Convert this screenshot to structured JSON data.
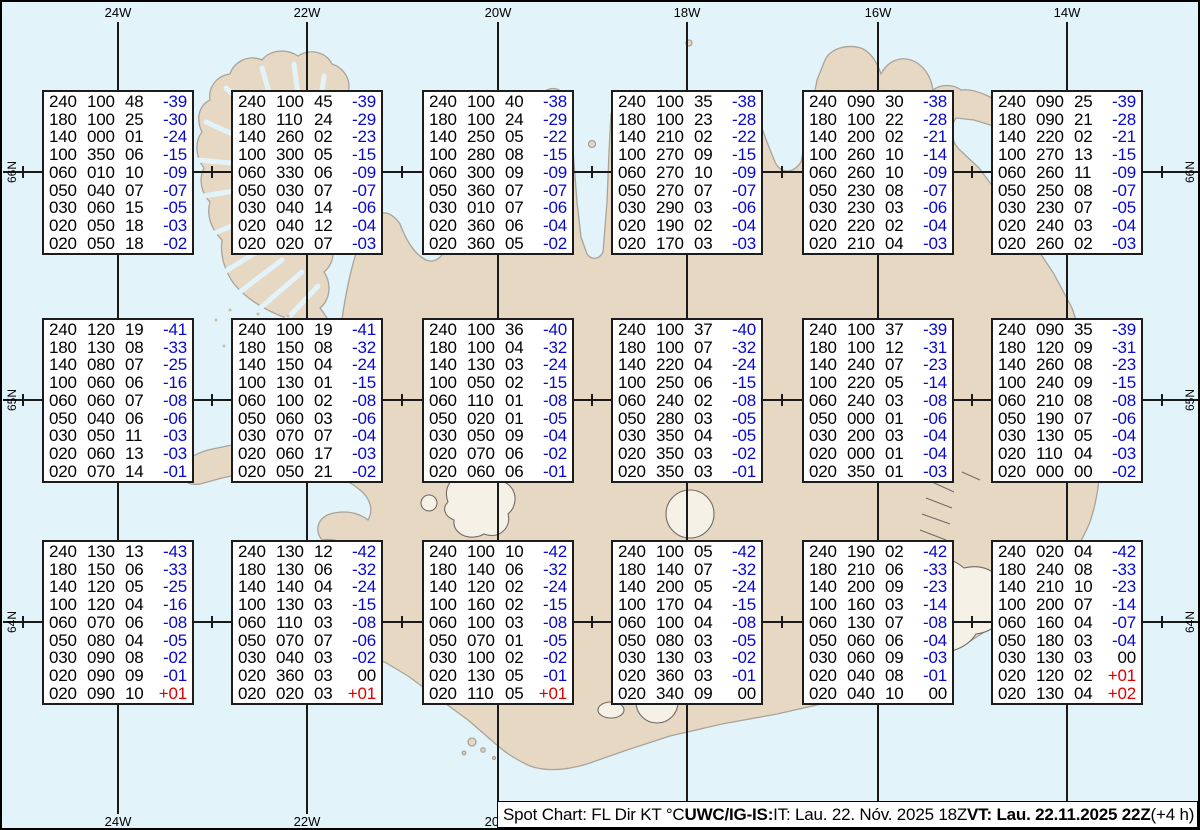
{
  "chart_title": "Spot Chart",
  "colors": {
    "ocean": "#e2f4fa",
    "land": "#e7d8c3",
    "coastline": "#a9a39a",
    "glacier": "#f6f1e7",
    "glacier_outline": "#6f6a62",
    "grid": "#1a1a1a",
    "temp_negative": "#0808cc",
    "temp_positive": "#dd0000"
  },
  "graticule": {
    "meridians": [
      {
        "label": "24W",
        "x": 116
      },
      {
        "label": "22W",
        "x": 305
      },
      {
        "label": "20W",
        "x": 496
      },
      {
        "label": "18W",
        "x": 685
      },
      {
        "label": "16W",
        "x": 876
      },
      {
        "label": "14W",
        "x": 1065
      }
    ],
    "latitudes": [
      {
        "label": "66N",
        "y": 170
      },
      {
        "label": "65N",
        "y": 398
      },
      {
        "label": "64N",
        "y": 620
      }
    ],
    "cross_xs": [
      21,
      210,
      400,
      590,
      780,
      970,
      1160
    ]
  },
  "columns": [
    "FL",
    "Dir",
    "KT",
    "Temp"
  ],
  "spots": [
    {
      "x": 40,
      "y": 88,
      "rows": [
        [
          "240",
          "100",
          "48",
          "-39"
        ],
        [
          "180",
          "100",
          "25",
          "-30"
        ],
        [
          "140",
          "000",
          "01",
          "-24"
        ],
        [
          "100",
          "350",
          "06",
          "-15"
        ],
        [
          "060",
          "010",
          "10",
          "-09"
        ],
        [
          "050",
          "040",
          "07",
          "-07"
        ],
        [
          "030",
          "060",
          "15",
          "-05"
        ],
        [
          "020",
          "050",
          "18",
          "-03"
        ],
        [
          "020",
          "050",
          "18",
          "-02"
        ]
      ]
    },
    {
      "x": 229,
      "y": 88,
      "rows": [
        [
          "240",
          "100",
          "45",
          "-39"
        ],
        [
          "180",
          "110",
          "24",
          "-29"
        ],
        [
          "140",
          "260",
          "02",
          "-23"
        ],
        [
          "100",
          "300",
          "05",
          "-15"
        ],
        [
          "060",
          "330",
          "06",
          "-09"
        ],
        [
          "050",
          "030",
          "07",
          "-07"
        ],
        [
          "030",
          "040",
          "14",
          "-06"
        ],
        [
          "020",
          "040",
          "12",
          "-04"
        ],
        [
          "020",
          "020",
          "07",
          "-03"
        ]
      ]
    },
    {
      "x": 420,
      "y": 88,
      "rows": [
        [
          "240",
          "100",
          "40",
          "-38"
        ],
        [
          "180",
          "100",
          "24",
          "-29"
        ],
        [
          "140",
          "250",
          "05",
          "-22"
        ],
        [
          "100",
          "280",
          "08",
          "-15"
        ],
        [
          "060",
          "300",
          "09",
          "-09"
        ],
        [
          "050",
          "360",
          "07",
          "-07"
        ],
        [
          "030",
          "010",
          "07",
          "-06"
        ],
        [
          "020",
          "360",
          "06",
          "-04"
        ],
        [
          "020",
          "360",
          "05",
          "-02"
        ]
      ]
    },
    {
      "x": 609,
      "y": 88,
      "rows": [
        [
          "240",
          "100",
          "35",
          "-38"
        ],
        [
          "180",
          "100",
          "23",
          "-28"
        ],
        [
          "140",
          "210",
          "02",
          "-22"
        ],
        [
          "100",
          "270",
          "09",
          "-15"
        ],
        [
          "060",
          "270",
          "10",
          "-09"
        ],
        [
          "050",
          "270",
          "07",
          "-07"
        ],
        [
          "030",
          "290",
          "03",
          "-06"
        ],
        [
          "020",
          "190",
          "02",
          "-04"
        ],
        [
          "020",
          "170",
          "03",
          "-03"
        ]
      ]
    },
    {
      "x": 800,
      "y": 88,
      "rows": [
        [
          "240",
          "090",
          "30",
          "-38"
        ],
        [
          "180",
          "100",
          "22",
          "-28"
        ],
        [
          "140",
          "200",
          "02",
          "-21"
        ],
        [
          "100",
          "260",
          "10",
          "-14"
        ],
        [
          "060",
          "260",
          "10",
          "-09"
        ],
        [
          "050",
          "230",
          "08",
          "-07"
        ],
        [
          "030",
          "230",
          "03",
          "-06"
        ],
        [
          "020",
          "220",
          "02",
          "-04"
        ],
        [
          "020",
          "210",
          "04",
          "-03"
        ]
      ]
    },
    {
      "x": 989,
      "y": 88,
      "rows": [
        [
          "240",
          "090",
          "25",
          "-39"
        ],
        [
          "180",
          "090",
          "21",
          "-28"
        ],
        [
          "140",
          "220",
          "02",
          "-21"
        ],
        [
          "100",
          "270",
          "13",
          "-15"
        ],
        [
          "060",
          "260",
          "11",
          "-09"
        ],
        [
          "050",
          "250",
          "08",
          "-07"
        ],
        [
          "030",
          "230",
          "07",
          "-05"
        ],
        [
          "020",
          "240",
          "03",
          "-04"
        ],
        [
          "020",
          "260",
          "02",
          "-03"
        ]
      ]
    },
    {
      "x": 40,
      "y": 316,
      "rows": [
        [
          "240",
          "120",
          "19",
          "-41"
        ],
        [
          "180",
          "130",
          "08",
          "-33"
        ],
        [
          "140",
          "080",
          "07",
          "-25"
        ],
        [
          "100",
          "060",
          "06",
          "-16"
        ],
        [
          "060",
          "060",
          "07",
          "-08"
        ],
        [
          "050",
          "040",
          "06",
          "-06"
        ],
        [
          "030",
          "050",
          "11",
          "-03"
        ],
        [
          "020",
          "060",
          "13",
          "-03"
        ],
        [
          "020",
          "070",
          "14",
          "-01"
        ]
      ]
    },
    {
      "x": 229,
      "y": 316,
      "rows": [
        [
          "240",
          "100",
          "19",
          "-41"
        ],
        [
          "180",
          "150",
          "08",
          "-32"
        ],
        [
          "140",
          "150",
          "04",
          "-24"
        ],
        [
          "100",
          "130",
          "01",
          "-15"
        ],
        [
          "060",
          "100",
          "02",
          "-08"
        ],
        [
          "050",
          "060",
          "03",
          "-06"
        ],
        [
          "030",
          "070",
          "07",
          "-04"
        ],
        [
          "020",
          "060",
          "17",
          "-03"
        ],
        [
          "020",
          "050",
          "21",
          "-02"
        ]
      ]
    },
    {
      "x": 420,
      "y": 316,
      "rows": [
        [
          "240",
          "100",
          "36",
          "-40"
        ],
        [
          "180",
          "100",
          "04",
          "-32"
        ],
        [
          "140",
          "130",
          "03",
          "-24"
        ],
        [
          "100",
          "050",
          "02",
          "-15"
        ],
        [
          "060",
          "110",
          "01",
          "-08"
        ],
        [
          "050",
          "020",
          "01",
          "-05"
        ],
        [
          "030",
          "050",
          "09",
          "-04"
        ],
        [
          "020",
          "070",
          "06",
          "-02"
        ],
        [
          "020",
          "060",
          "06",
          "-01"
        ]
      ]
    },
    {
      "x": 609,
      "y": 316,
      "rows": [
        [
          "240",
          "100",
          "37",
          "-40"
        ],
        [
          "180",
          "100",
          "07",
          "-32"
        ],
        [
          "140",
          "220",
          "04",
          "-24"
        ],
        [
          "100",
          "250",
          "06",
          "-15"
        ],
        [
          "060",
          "240",
          "02",
          "-08"
        ],
        [
          "050",
          "280",
          "03",
          "-05"
        ],
        [
          "030",
          "350",
          "04",
          "-05"
        ],
        [
          "020",
          "350",
          "03",
          "-02"
        ],
        [
          "020",
          "350",
          "03",
          "-01"
        ]
      ]
    },
    {
      "x": 800,
      "y": 316,
      "rows": [
        [
          "240",
          "100",
          "37",
          "-39"
        ],
        [
          "180",
          "100",
          "12",
          "-31"
        ],
        [
          "140",
          "240",
          "07",
          "-23"
        ],
        [
          "100",
          "220",
          "05",
          "-14"
        ],
        [
          "060",
          "240",
          "03",
          "-08"
        ],
        [
          "050",
          "000",
          "01",
          "-06"
        ],
        [
          "030",
          "200",
          "03",
          "-04"
        ],
        [
          "020",
          "000",
          "01",
          "-04"
        ],
        [
          "020",
          "350",
          "01",
          "-03"
        ]
      ]
    },
    {
      "x": 989,
      "y": 316,
      "rows": [
        [
          "240",
          "090",
          "35",
          "-39"
        ],
        [
          "180",
          "120",
          "09",
          "-31"
        ],
        [
          "140",
          "260",
          "08",
          "-23"
        ],
        [
          "100",
          "240",
          "09",
          "-15"
        ],
        [
          "060",
          "210",
          "08",
          "-08"
        ],
        [
          "050",
          "190",
          "07",
          "-06"
        ],
        [
          "030",
          "130",
          "05",
          "-04"
        ],
        [
          "020",
          "110",
          "04",
          "-03"
        ],
        [
          "020",
          "000",
          "00",
          "-02"
        ]
      ]
    },
    {
      "x": 40,
      "y": 538,
      "rows": [
        [
          "240",
          "130",
          "13",
          "-43"
        ],
        [
          "180",
          "150",
          "06",
          "-33"
        ],
        [
          "140",
          "120",
          "05",
          "-25"
        ],
        [
          "100",
          "120",
          "04",
          "-16"
        ],
        [
          "060",
          "070",
          "06",
          "-08"
        ],
        [
          "050",
          "080",
          "04",
          "-05"
        ],
        [
          "030",
          "090",
          "08",
          "-02"
        ],
        [
          "020",
          "090",
          "09",
          "-01"
        ],
        [
          "020",
          "090",
          "10",
          "+01"
        ]
      ]
    },
    {
      "x": 229,
      "y": 538,
      "rows": [
        [
          "240",
          "130",
          "12",
          "-42"
        ],
        [
          "180",
          "130",
          "06",
          "-32"
        ],
        [
          "140",
          "140",
          "04",
          "-24"
        ],
        [
          "100",
          "130",
          "03",
          "-15"
        ],
        [
          "060",
          "110",
          "03",
          "-08"
        ],
        [
          "050",
          "070",
          "07",
          "-06"
        ],
        [
          "030",
          "040",
          "03",
          "-02"
        ],
        [
          "020",
          "360",
          "03",
          "00"
        ],
        [
          "020",
          "020",
          "03",
          "+01"
        ]
      ]
    },
    {
      "x": 420,
      "y": 538,
      "rows": [
        [
          "240",
          "100",
          "10",
          "-42"
        ],
        [
          "180",
          "140",
          "06",
          "-32"
        ],
        [
          "140",
          "120",
          "02",
          "-24"
        ],
        [
          "100",
          "160",
          "02",
          "-15"
        ],
        [
          "060",
          "100",
          "03",
          "-08"
        ],
        [
          "050",
          "070",
          "01",
          "-05"
        ],
        [
          "030",
          "100",
          "02",
          "-02"
        ],
        [
          "020",
          "130",
          "05",
          "-01"
        ],
        [
          "020",
          "110",
          "05",
          "+01"
        ]
      ]
    },
    {
      "x": 609,
      "y": 538,
      "rows": [
        [
          "240",
          "100",
          "05",
          "-42"
        ],
        [
          "180",
          "140",
          "07",
          "-32"
        ],
        [
          "140",
          "200",
          "05",
          "-24"
        ],
        [
          "100",
          "170",
          "04",
          "-15"
        ],
        [
          "060",
          "100",
          "04",
          "-08"
        ],
        [
          "050",
          "080",
          "03",
          "-05"
        ],
        [
          "030",
          "130",
          "03",
          "-02"
        ],
        [
          "020",
          "360",
          "03",
          "-01"
        ],
        [
          "020",
          "340",
          "09",
          "00"
        ]
      ]
    },
    {
      "x": 800,
      "y": 538,
      "rows": [
        [
          "240",
          "190",
          "02",
          "-42"
        ],
        [
          "180",
          "210",
          "06",
          "-33"
        ],
        [
          "140",
          "200",
          "09",
          "-23"
        ],
        [
          "100",
          "160",
          "03",
          "-14"
        ],
        [
          "060",
          "130",
          "07",
          "-08"
        ],
        [
          "050",
          "060",
          "06",
          "-04"
        ],
        [
          "030",
          "060",
          "09",
          "-03"
        ],
        [
          "020",
          "040",
          "08",
          "-01"
        ],
        [
          "020",
          "040",
          "10",
          "00"
        ]
      ]
    },
    {
      "x": 989,
      "y": 538,
      "rows": [
        [
          "240",
          "020",
          "04",
          "-42"
        ],
        [
          "180",
          "240",
          "08",
          "-33"
        ],
        [
          "140",
          "210",
          "10",
          "-23"
        ],
        [
          "100",
          "200",
          "07",
          "-14"
        ],
        [
          "060",
          "160",
          "04",
          "-07"
        ],
        [
          "050",
          "180",
          "03",
          "-04"
        ],
        [
          "030",
          "130",
          "03",
          "00"
        ],
        [
          "020",
          "120",
          "02",
          "+01"
        ],
        [
          "020",
          "130",
          "04",
          "+02"
        ]
      ]
    }
  ],
  "footer": {
    "segments": [
      {
        "text": "Spot Chart: FL Dir KT °C ",
        "bold": false
      },
      {
        "text": "UWC/IG-IS:",
        "bold": true
      },
      {
        "text": " IT: Lau. 22. Nóv. 2025 18Z ",
        "bold": false
      },
      {
        "text": "VT: Lau. 22.11.2025 22Z",
        "bold": true
      },
      {
        "text": " (+4 h)",
        "bold": false
      }
    ]
  }
}
